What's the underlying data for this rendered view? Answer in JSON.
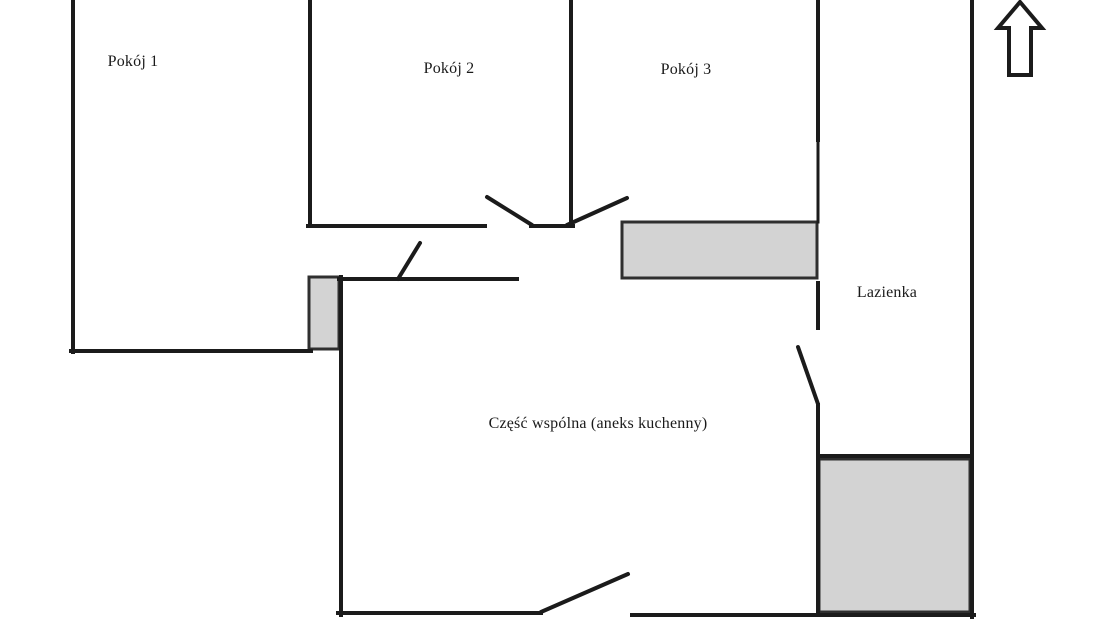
{
  "rooms": [
    {
      "id": "room-1",
      "label": "Pokój 1"
    },
    {
      "id": "room-2",
      "label": "Pokój 2"
    },
    {
      "id": "room-3",
      "label": "Pokój 3"
    },
    {
      "id": "bathroom",
      "label": "Lazienka"
    },
    {
      "id": "common-area",
      "label": "Część wspólna (aneks kuchenny)"
    }
  ],
  "icons": {
    "north_arrow": "up-arrow-outline"
  },
  "colors": {
    "wall_color": "#1b1b1b",
    "block_fill": "#d3d3d3",
    "block_border": "#2f2f2f",
    "bg_color": "#ffffff",
    "text_color": "#1a1a1a"
  }
}
